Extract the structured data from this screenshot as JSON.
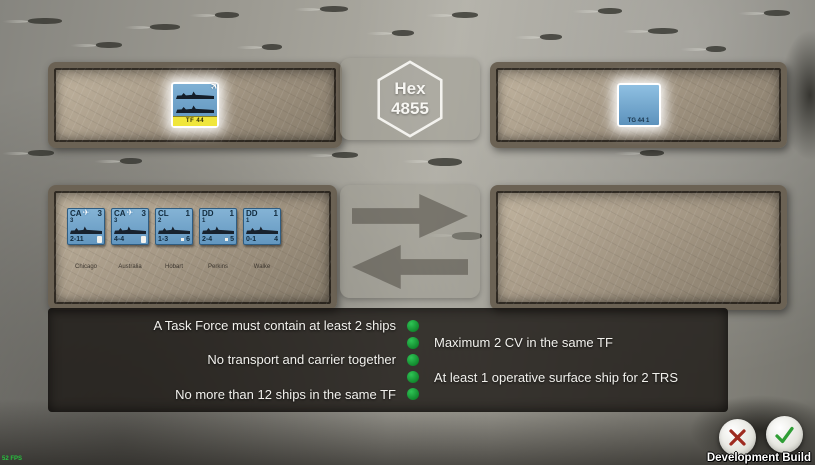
{
  "hud": {
    "fps": "52 FPS",
    "build_label": "Development Build"
  },
  "hex_panel": {
    "line1": "Hex",
    "line2": "4855"
  },
  "task_force": {
    "counter_label": "TF 44"
  },
  "task_group": {
    "counter_label": "TG 44 1"
  },
  "fleet": {
    "ships": [
      {
        "type": "CA",
        "top_right": "3",
        "below": "3",
        "has_plane": true,
        "bottom_left": "2-11",
        "bottom_right": "",
        "has_speed_box": true,
        "name": "Chicago"
      },
      {
        "type": "CA",
        "top_right": "3",
        "below": "3",
        "has_plane": true,
        "bottom_left": "4-4",
        "bottom_right": "",
        "has_speed_box": true,
        "name": "Australia"
      },
      {
        "type": "CL",
        "top_right": "1",
        "below": "2",
        "has_plane": false,
        "bottom_left": "1-3",
        "bottom_right": "6",
        "has_speed_box": false,
        "name": "Hobart"
      },
      {
        "type": "DD",
        "top_right": "1",
        "below": "1",
        "has_plane": false,
        "bottom_left": "2-4",
        "bottom_right": "5",
        "has_speed_box": false,
        "name": "Perkins"
      },
      {
        "type": "DD",
        "top_right": "1",
        "below": "1",
        "has_plane": false,
        "bottom_left": "0-1",
        "bottom_right": "4",
        "has_speed_box": false,
        "name": "Walke"
      }
    ]
  },
  "rules": {
    "items": [
      {
        "text": "A Task Force must contain at least 2 ships",
        "side": "left",
        "status": "ok"
      },
      {
        "text": "Maximum 2 CV in the same TF",
        "side": "right",
        "status": "ok"
      },
      {
        "text": "No transport and carrier together",
        "side": "left",
        "status": "ok"
      },
      {
        "text": "At least 1 operative surface ship for 2 TRS",
        "side": "right",
        "status": "ok"
      },
      {
        "text": "No more than 12 ships in the same TF",
        "side": "left",
        "status": "ok"
      }
    ]
  },
  "colors": {
    "status_ok": "#1f9e3c",
    "cancel_icon": "#9e2b20",
    "confirm_icon": "#2f9e35",
    "counter_blue": "#72a7cd",
    "tf_band_yellow": "#f0e63c",
    "panel_metal": "#a89b88",
    "rules_bg": "#1c1814"
  }
}
